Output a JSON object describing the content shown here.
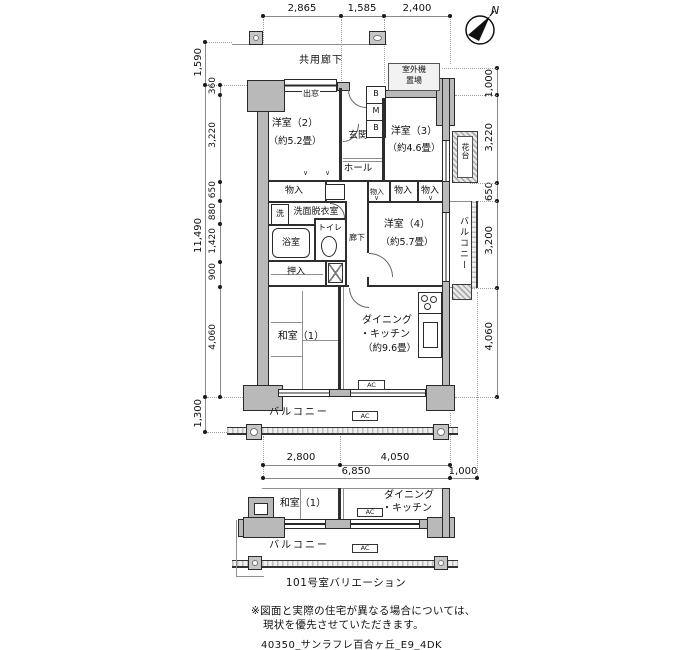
{
  "compass": {
    "north": "N"
  },
  "dims": {
    "top": {
      "a": "2,865",
      "b": "1,585",
      "c": "2,400"
    },
    "left": {
      "t1590": "1,590",
      "total": "11,490",
      "b1300": "1,300",
      "s1": "360",
      "s2": "3,220",
      "s3": "650",
      "s4": "880",
      "s5": "1,420",
      "s6": "900",
      "s7": "4,060"
    },
    "right": {
      "r1": "1,000",
      "r2": "3,220",
      "r3": "650",
      "r4": "3,200",
      "r5": "4,060"
    },
    "bottom": {
      "b1": "2,800",
      "b2": "4,050",
      "b3": "6,850",
      "b4": "1,000"
    }
  },
  "plan": {
    "corridor": "共用廊下",
    "bay_window": "出窓",
    "outdoor_unit_line1": "室外機",
    "outdoor_unit_line2": "置場",
    "mb_top": "B",
    "mb_mid": "M",
    "mb_bot": "B",
    "entrance": "玄関",
    "hall": "ホール",
    "room2": "洋室（2）",
    "room2_size": "（約5.2畳）",
    "room3": "洋室（3）",
    "room3_size": "（約4.6畳）",
    "room4": "洋室（4）",
    "room4_size": "（約5.7畳）",
    "storage": "物入",
    "washer": "洗",
    "washroom": "洗面脱衣室",
    "bath": "浴室",
    "toilet": "トイレ",
    "hallway": "廊下",
    "closet": "押入",
    "flower_stand": "花台",
    "balcony": "バルコニー",
    "japanese_room": "和室（1）",
    "dk_line1": "ダイニング",
    "dk_line2": "・キッチン",
    "dk_size": "（約9.6畳）",
    "ac": "AC",
    "fold_mark": "∨"
  },
  "variation": {
    "japanese_room": "和室（1）",
    "dk_line1": "ダイニング",
    "dk_line2": "・キッチン",
    "balcony": "バルコニー",
    "ac": "AC",
    "caption": "101号室バリエーション"
  },
  "notes": {
    "line1": "※図面と実際の住宅が異なる場合については、",
    "line2": "現状を優先させていただきます。",
    "footer": "40350_サンラフレ百合ヶ丘_E9_4DK"
  }
}
